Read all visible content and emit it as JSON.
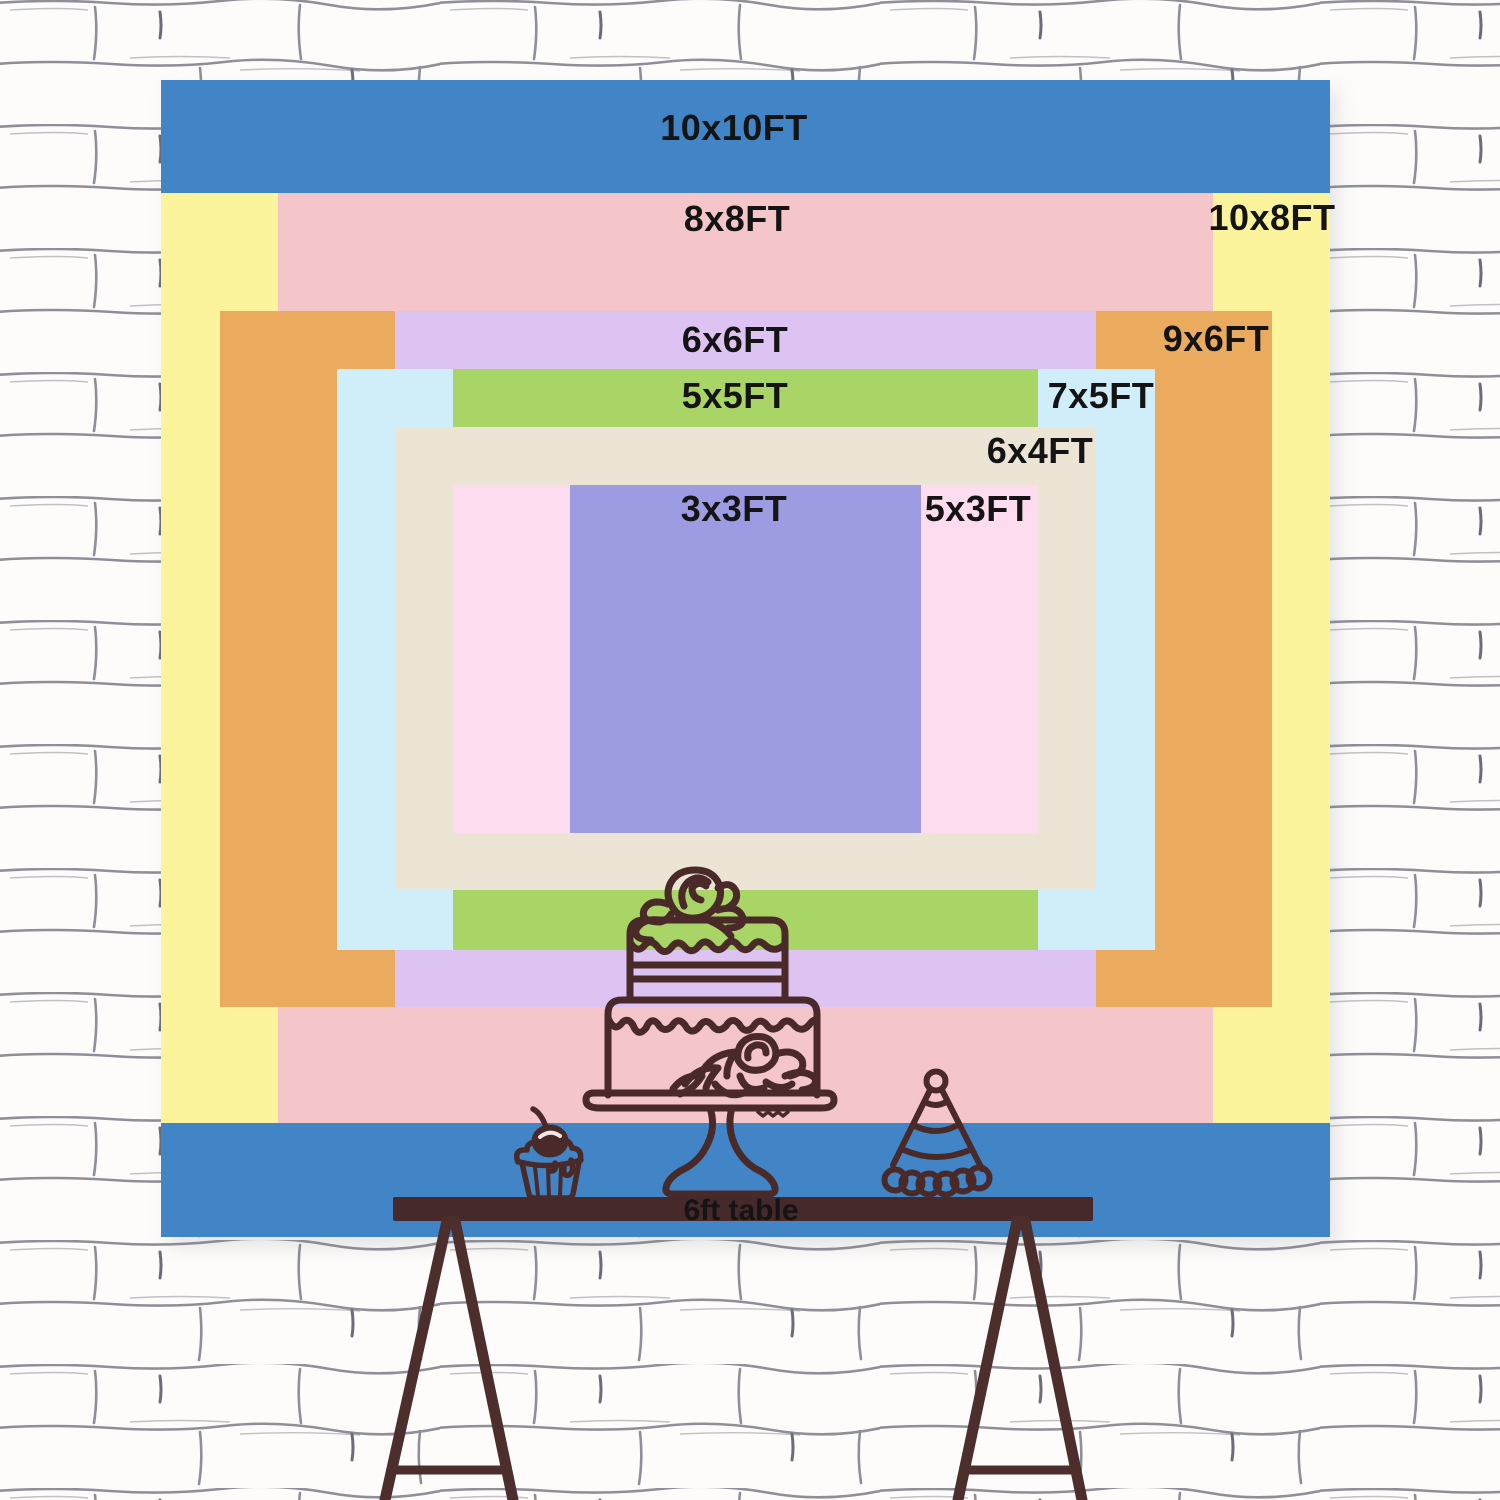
{
  "title": "Backdrop size comparison chart",
  "text_color": "#141414",
  "layers": [
    {
      "id": "10x10",
      "label": "10x10FT",
      "color": "#4285c6"
    },
    {
      "id": "10x8",
      "label": "10x8FT",
      "color": "#fcf49d"
    },
    {
      "id": "8x8",
      "label": "8x8FT",
      "color": "#f4c6c9"
    },
    {
      "id": "9x6",
      "label": "9x6FT",
      "color": "#eaab5f"
    },
    {
      "id": "6x6",
      "label": "6x6FT",
      "color": "#ddc3f2"
    },
    {
      "id": "7x5",
      "label": "7x5FT",
      "color": "#cfeef9"
    },
    {
      "id": "5x5",
      "label": "5x5FT",
      "color": "#a9d466"
    },
    {
      "id": "6x4",
      "label": "6x4FT",
      "color": "#ece4d4"
    },
    {
      "id": "5x3",
      "label": "5x3FT",
      "color": "#fcdcee"
    },
    {
      "id": "3x3",
      "label": "3x3FT",
      "color": "#9d9ce2"
    }
  ],
  "table": {
    "label": "6ft table",
    "surface_color": "#46292a",
    "leg_color": "#4c2e2d"
  },
  "illustrations": {
    "stroke_color": "#492a28",
    "cherry_highlight": "#f3e6e6",
    "cake": "two-tier-birthday-cake-line-art",
    "cupcake": "cupcake-with-cherry-line-art",
    "hat": "striped-party-hat-line-art"
  },
  "wall": {
    "base": "#f8f7f5",
    "brick": "#fdfcfb",
    "mortar": "#8f8f98",
    "mortar_accent": "#6d6d78"
  }
}
